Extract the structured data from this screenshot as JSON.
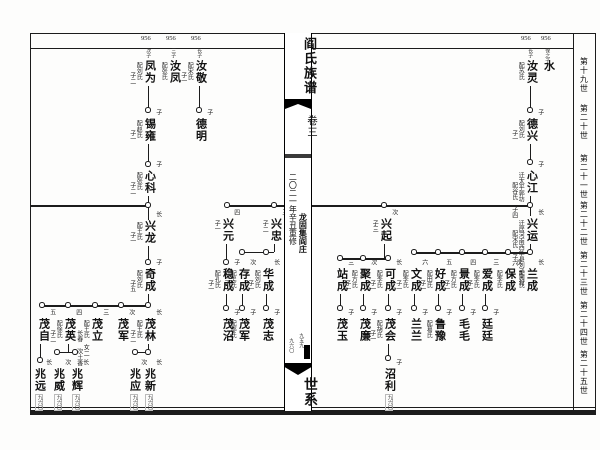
{
  "spine": {
    "title": "阎氏族谱",
    "volume": "卷三",
    "place": "龙固集阎庄",
    "edition": "二〇二一年辛丑重修",
    "page_right": "九五九",
    "page_left": "九六〇",
    "section": "世系"
  },
  "generation_labels": [
    {
      "label": "第十九世",
      "y": 57
    },
    {
      "label": "第二十世",
      "y": 104
    },
    {
      "label": "第二十一世",
      "y": 154
    },
    {
      "label": "第二十二世",
      "y": 201
    },
    {
      "label": "第二十三世",
      "y": 251
    },
    {
      "label": "第二十四世",
      "y": 301
    },
    {
      "label": "第二十五世",
      "y": 350
    }
  ],
  "page_refs_top": [
    {
      "text": "956",
      "x": 141
    },
    {
      "text": "956",
      "x": 166
    },
    {
      "text": "956",
      "x": 191
    },
    {
      "text": "956",
      "x": 521
    },
    {
      "text": "956",
      "x": 541
    }
  ],
  "tree": {
    "persons": [
      {
        "id": "shui",
        "n": "水",
        "x": 547,
        "y": 60,
        "t": "保之子"
      },
      {
        "id": "ruling",
        "n": "汝灵",
        "x": 530,
        "y": 60,
        "t": "长子",
        "l": [
          "配苏氏"
        ]
      },
      {
        "id": "dexing",
        "n": "德兴",
        "x": 530,
        "y": 118,
        "r": "子",
        "l": [
          "配刘氏",
          "子一"
        ]
      },
      {
        "id": "xinjiang",
        "n": "心江",
        "x": 530,
        "y": 170,
        "r": "子",
        "l": [
          "迁太平郭坊",
          "配谷氏 子四"
        ]
      },
      {
        "id": "xingyun",
        "n": "兴运",
        "x": 530,
        "y": 218,
        "r": "长",
        "l": [
          "迁居河南西华县刘子河村",
          "配宋氏 子六"
        ]
      },
      {
        "id": "lancheng",
        "n": "兰成",
        "x": 530,
        "y": 268,
        "r": "长",
        "l": [
          "配刘氏"
        ]
      },
      {
        "id": "baocheng",
        "n": "保成",
        "x": 508,
        "y": 268,
        "r": "次",
        "l": [
          "配李氏"
        ]
      },
      {
        "id": "aicheng",
        "n": "爱成",
        "x": 485,
        "y": 268,
        "r": "三",
        "l": [
          "配李氏",
          "子一"
        ]
      },
      {
        "id": "jingcheng",
        "n": "景成",
        "x": 462,
        "y": 268,
        "r": "四",
        "l": [
          "配方氏",
          "子一"
        ]
      },
      {
        "id": "haocheng",
        "n": "好成",
        "x": 438,
        "y": 268,
        "r": "五",
        "l": [
          "配田氏",
          "子一"
        ]
      },
      {
        "id": "wencheng",
        "n": "文成",
        "x": 414,
        "y": 268,
        "r": "六",
        "l": [
          "配李氏",
          "子一"
        ]
      },
      {
        "id": "tingting",
        "n": "廷廷",
        "x": 485,
        "y": 318,
        "r": "子"
      },
      {
        "id": "maomao",
        "n": "毛毛",
        "x": 462,
        "y": 318,
        "r": "子"
      },
      {
        "id": "luyu",
        "n": "鲁豫",
        "x": 438,
        "y": 318,
        "r": "子",
        "l": [
          "配葛氏"
        ]
      },
      {
        "id": "lanlan",
        "n": "兰兰",
        "x": 414,
        "y": 318,
        "r": "子"
      },
      {
        "id": "xingqi",
        "n": "兴起",
        "x": 384,
        "y": 218,
        "r": "次",
        "l": [
          "子三"
        ]
      },
      {
        "id": "kecheng",
        "n": "可成",
        "x": 388,
        "y": 268,
        "r": "长",
        "l": [
          "配李氏",
          "子一"
        ]
      },
      {
        "id": "jucheng",
        "n": "聚成",
        "x": 363,
        "y": 268,
        "r": "次",
        "l": [
          "配方氏",
          "子一"
        ]
      },
      {
        "id": "zhancheng",
        "n": "站成",
        "x": 340,
        "y": 268,
        "r": "三"
      },
      {
        "id": "maohui",
        "n": "茂会",
        "x": 388,
        "y": 318,
        "r": "子",
        "l": [
          "配胡氏",
          "子一"
        ]
      },
      {
        "id": "maolian",
        "n": "茂廉",
        "x": 363,
        "y": 318,
        "r": "子"
      },
      {
        "id": "maoyu",
        "n": "茂玉",
        "x": 340,
        "y": 318,
        "r": "子"
      },
      {
        "id": "zhaoli",
        "n": "沼利",
        "x": 388,
        "y": 368,
        "r": "子",
        "b": "九六〇"
      },
      {
        "id": "fengwei",
        "n": "凤为",
        "x": 148,
        "y": 60,
        "t": "次子",
        "l": [
          "配刘氏",
          "子二"
        ]
      },
      {
        "id": "rufeng",
        "n": "汝凤",
        "x": 173,
        "y": 60,
        "t": "三子",
        "l": [
          "配张氏"
        ]
      },
      {
        "id": "rujing",
        "n": "汝敬",
        "x": 199,
        "y": 60,
        "t": "长子",
        "l": [
          "配宋氏",
          "子一"
        ]
      },
      {
        "id": "deming",
        "n": "德明",
        "x": 199,
        "y": 118,
        "r": "子"
      },
      {
        "id": "xiyong",
        "n": "锡雍",
        "x": 148,
        "y": 118,
        "r": "子",
        "l": [
          "配赵氏",
          "子一"
        ]
      },
      {
        "id": "xinke",
        "n": "心科",
        "x": 148,
        "y": 170,
        "r": "子",
        "l": [
          "配张氏",
          "子二"
        ]
      },
      {
        "id": "xinglong",
        "n": "兴龙",
        "x": 148,
        "y": 220,
        "r": "长",
        "l": [
          "配王氏",
          "子一"
        ]
      },
      {
        "id": "qicheng",
        "n": "奇成",
        "x": 148,
        "y": 268,
        "r": "子",
        "l": [
          "配刘氏",
          "子五"
        ]
      },
      {
        "id": "maolin",
        "n": "茂林",
        "x": 148,
        "y": 318,
        "r": "长",
        "l": [
          "配王氏",
          "子二"
        ]
      },
      {
        "id": "maojun-a",
        "n": "茂军",
        "x": 121,
        "y": 318,
        "r": "次"
      },
      {
        "id": "maoli",
        "n": "茂立",
        "x": 95,
        "y": 318,
        "r": "三",
        "l": [
          "配王氏 女二",
          "长春 次土香"
        ]
      },
      {
        "id": "maoying",
        "n": "茂英",
        "x": 68,
        "y": 318,
        "r": "四",
        "l": [
          "配徐氏",
          "子二"
        ]
      },
      {
        "id": "maozi",
        "n": "茂自",
        "x": 42,
        "y": 318,
        "r": "五"
      },
      {
        "id": "zhaoxin",
        "n": "兆新",
        "x": 148,
        "y": 368,
        "r": "长",
        "b": "九六〇"
      },
      {
        "id": "zhaoying",
        "n": "兆应",
        "x": 133,
        "y": 368,
        "r": "次",
        "b": "九六〇"
      },
      {
        "id": "zhaohui",
        "n": "兆辉",
        "x": 75,
        "y": 368,
        "r": "长",
        "b": "九六〇"
      },
      {
        "id": "zhaowei",
        "n": "兆威",
        "x": 57,
        "y": 368,
        "r": "次",
        "b": "九六〇"
      },
      {
        "id": "zhaoyuan",
        "n": "兆远",
        "x": 38,
        "y": 368,
        "r": "长",
        "b": "九六〇"
      },
      {
        "id": "xingyuan",
        "n": "兴元",
        "x": 226,
        "y": 218,
        "r": "四",
        "l": [
          "子一"
        ]
      },
      {
        "id": "wencheng-l",
        "n": "稳成",
        "x": 226,
        "y": 268,
        "r": "子",
        "l": [
          "配孔氏",
          "子一"
        ]
      },
      {
        "id": "maozhao",
        "n": "茂沼",
        "x": 226,
        "y": 318,
        "r": "子"
      },
      {
        "id": "xingzhong",
        "n": "兴忠",
        "x": 274,
        "y": 218,
        "r": "三",
        "l": [
          "子二"
        ]
      },
      {
        "id": "huacheng",
        "n": "华成",
        "x": 266,
        "y": 268,
        "r": "长",
        "l": [
          "配刘氏",
          "子一"
        ]
      },
      {
        "id": "maozhi",
        "n": "茂志",
        "x": 266,
        "y": 318,
        "r": "子"
      },
      {
        "id": "cuncheng",
        "n": "存成",
        "x": 242,
        "y": 268,
        "r": "次",
        "l": [
          "配吴氏",
          "子一"
        ]
      },
      {
        "id": "maojun-b",
        "n": "茂军",
        "x": 242,
        "y": 318,
        "r": "子",
        "l": [
          "配邵氏"
        ]
      }
    ],
    "lines": [
      [
        148,
        86,
        148,
        110
      ],
      [
        199,
        86,
        199,
        110
      ],
      [
        148,
        144,
        148,
        164
      ],
      [
        148,
        196,
        148,
        220
      ],
      [
        30,
        205,
        148,
        205,
        2
      ],
      [
        148,
        246,
        148,
        262
      ],
      [
        148,
        294,
        148,
        305
      ],
      [
        42,
        305,
        148,
        305,
        1.8
      ],
      [
        148,
        344,
        148,
        352
      ],
      [
        135,
        352,
        148,
        352
      ],
      [
        68,
        344,
        68,
        352
      ],
      [
        57,
        352,
        75,
        352
      ],
      [
        40,
        344,
        40,
        360
      ],
      [
        226,
        244,
        226,
        262
      ],
      [
        226,
        294,
        226,
        308
      ],
      [
        274,
        244,
        274,
        252
      ],
      [
        242,
        252,
        274,
        252
      ],
      [
        266,
        294,
        266,
        308
      ],
      [
        242,
        294,
        242,
        308
      ],
      [
        530,
        86,
        530,
        110
      ],
      [
        530,
        144,
        530,
        162
      ],
      [
        530,
        196,
        530,
        216
      ],
      [
        227,
        205,
        286,
        205,
        2
      ],
      [
        308,
        205,
        530,
        205,
        2
      ],
      [
        530,
        244,
        530,
        252
      ],
      [
        414,
        252,
        530,
        252,
        1.8
      ],
      [
        384,
        244,
        384,
        258
      ],
      [
        340,
        258,
        388,
        258,
        1.8
      ],
      [
        485,
        294,
        485,
        308
      ],
      [
        462,
        294,
        462,
        308
      ],
      [
        438,
        294,
        438,
        308
      ],
      [
        414,
        294,
        414,
        308
      ],
      [
        388,
        294,
        388,
        308
      ],
      [
        363,
        294,
        363,
        308
      ],
      [
        340,
        294,
        340,
        308
      ],
      [
        388,
        344,
        388,
        358
      ]
    ],
    "dots": [
      [
        148,
        110
      ],
      [
        199,
        110
      ],
      [
        148,
        164
      ],
      [
        148,
        205
      ],
      [
        148,
        262
      ],
      [
        42,
        305
      ],
      [
        68,
        305
      ],
      [
        95,
        305
      ],
      [
        121,
        305
      ],
      [
        148,
        305
      ],
      [
        135,
        352
      ],
      [
        148,
        352
      ],
      [
        57,
        352
      ],
      [
        75,
        352
      ],
      [
        40,
        360
      ],
      [
        226,
        262
      ],
      [
        226,
        308
      ],
      [
        242,
        252
      ],
      [
        266,
        252
      ],
      [
        242,
        308
      ],
      [
        266,
        308
      ],
      [
        530,
        110
      ],
      [
        530,
        162
      ],
      [
        530,
        205
      ],
      [
        384,
        205
      ],
      [
        274,
        205
      ],
      [
        227,
        205
      ],
      [
        414,
        252
      ],
      [
        438,
        252
      ],
      [
        462,
        252
      ],
      [
        485,
        252
      ],
      [
        508,
        252
      ],
      [
        530,
        252
      ],
      [
        340,
        258
      ],
      [
        363,
        258
      ],
      [
        388,
        258
      ],
      [
        414,
        308
      ],
      [
        438,
        308
      ],
      [
        462,
        308
      ],
      [
        485,
        308
      ],
      [
        340,
        308
      ],
      [
        363,
        308
      ],
      [
        388,
        308
      ],
      [
        388,
        358
      ]
    ]
  }
}
